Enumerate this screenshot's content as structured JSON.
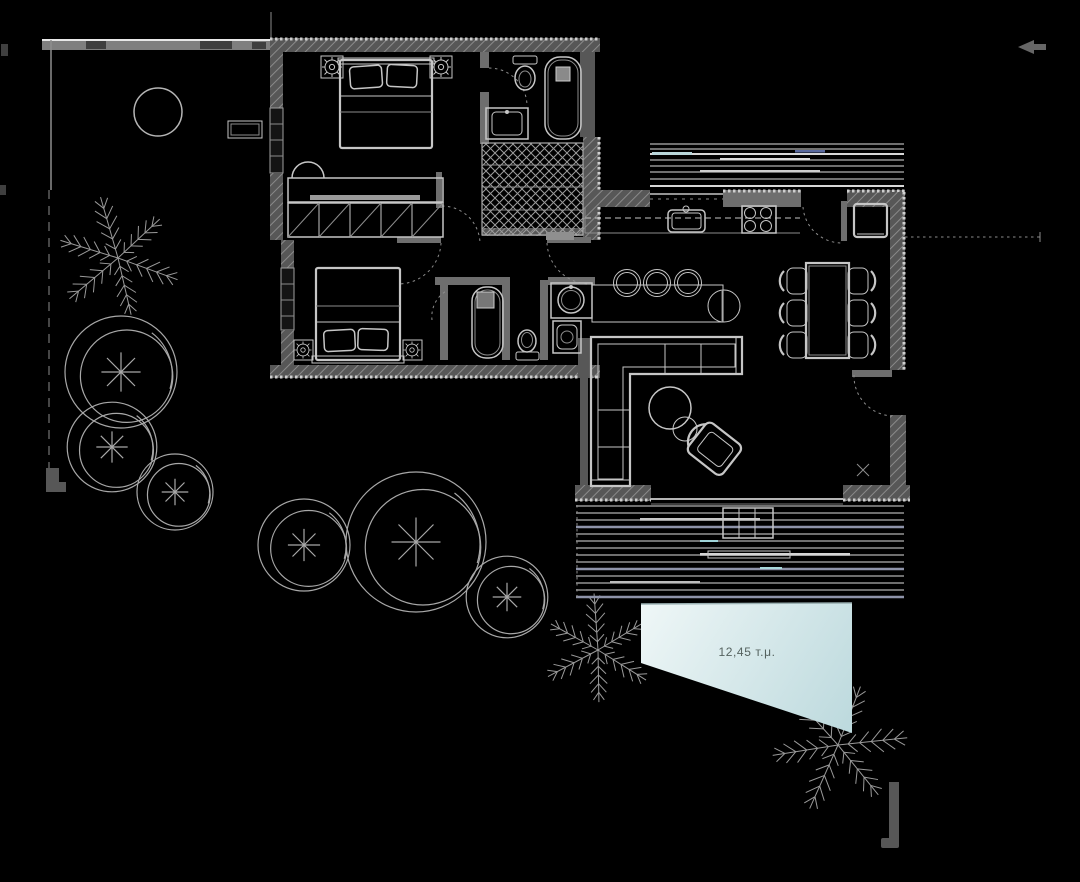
{
  "plan": {
    "pool": {
      "area_label": "12,45 т.μ."
    }
  },
  "symbols": {
    "tree-icon": "double circle with asterisk center",
    "palm-icon": "radiating fern fronds",
    "door-swing-icon": "dashed quarter arc",
    "north-arrow-icon": "left pointing arrow marker",
    "floor-drain-icon": "small x cross"
  },
  "colors": {
    "bg": "#000000",
    "line": "#c6c6c6",
    "line_bright": "#efefef",
    "line_dim": "#8d8d8d",
    "wall": "#575757",
    "wall_light": "#7f7f7f",
    "wall_dark": "#3f3f3f",
    "hatch": "#8a8a8a",
    "deck": "#6f6f6f",
    "deck_accent": "#8e93a9",
    "pool_start": "#eff7f7",
    "pool_end": "#bcd9dd",
    "pool_text": "#55625f"
  }
}
